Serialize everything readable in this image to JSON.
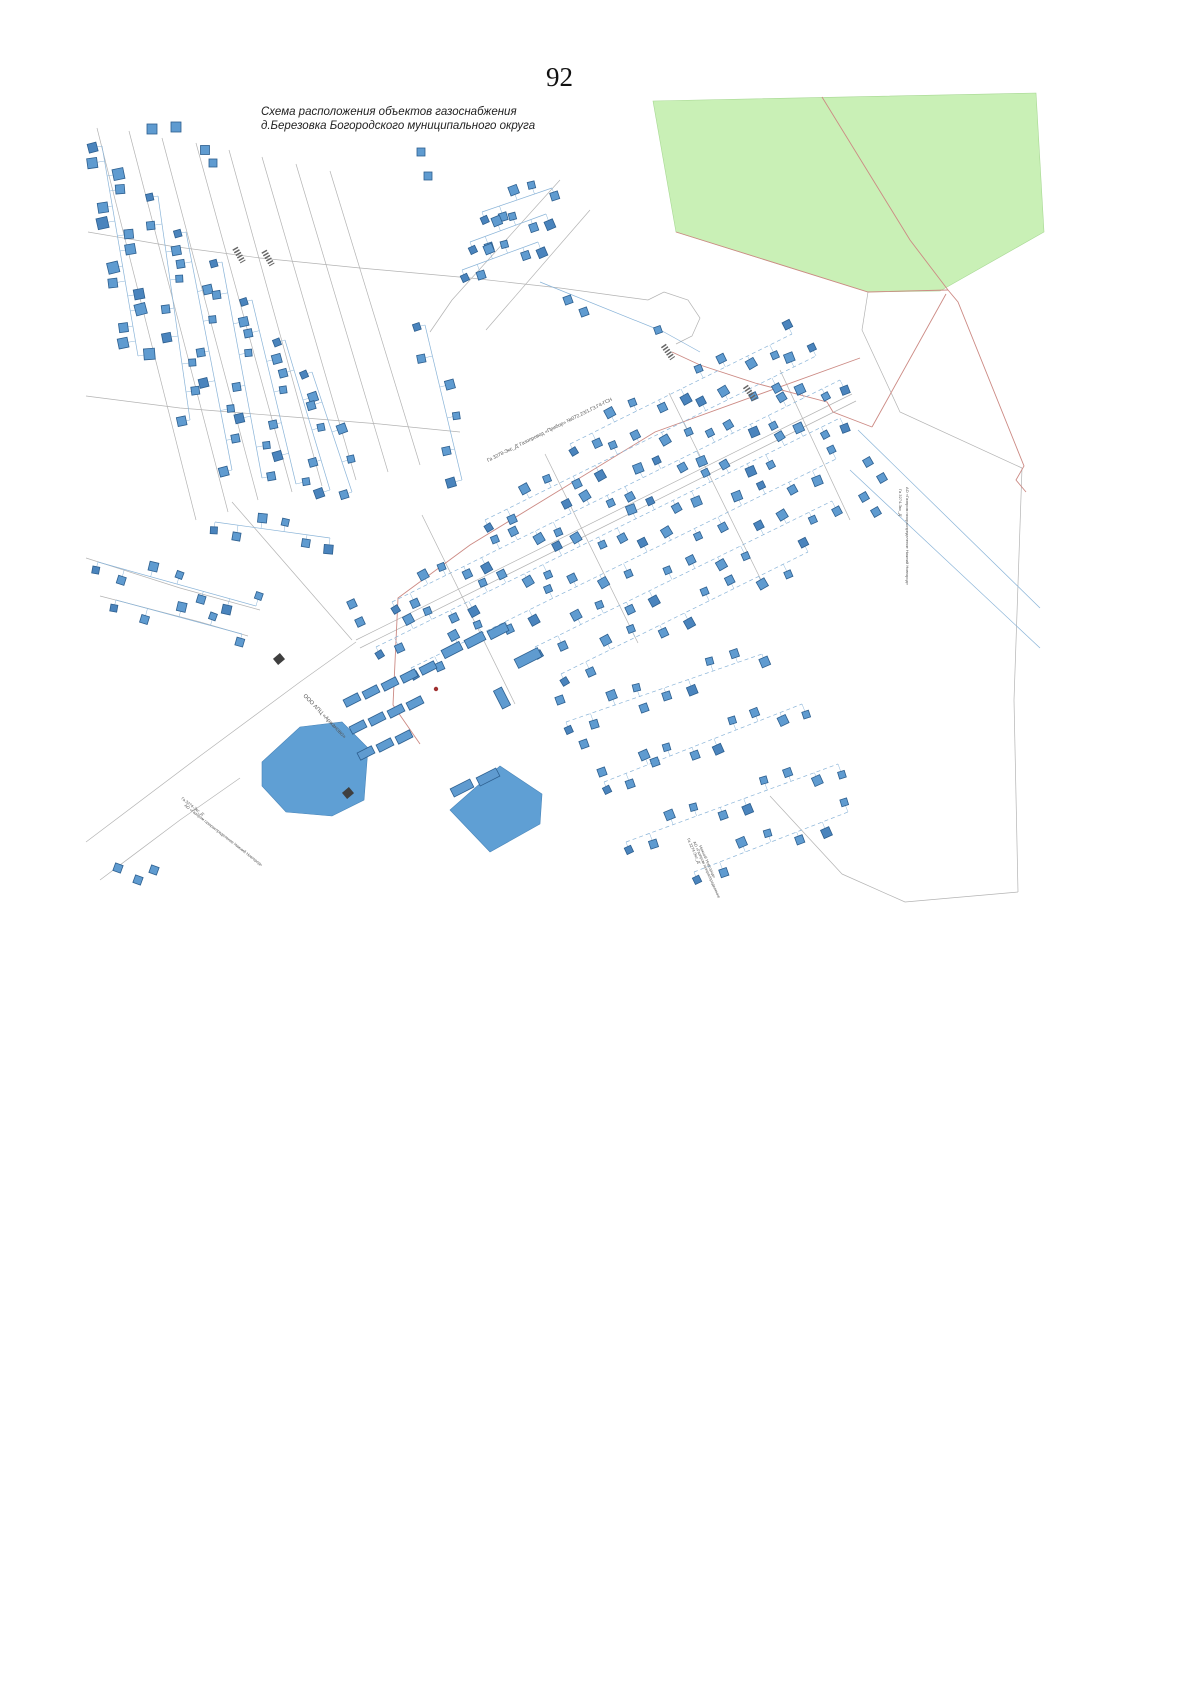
{
  "page": {
    "number": "92"
  },
  "title": {
    "line1": "Схема расположения объектов газоснабжения",
    "line2": "д.Березовка Богородского муниципального округа"
  },
  "colors": {
    "green": "#c9f0b6",
    "green_edge": "#a8d894",
    "pond": "#5f9fd4",
    "pond_edge": "#4a86ba",
    "road": "#b3b3b3",
    "boundary": "#cc8a84",
    "pipe": "#8ab4d8",
    "building": "#5f9bd0",
    "building_dark": "#4a84bd",
    "building_edge": "#2d5f8f",
    "label": "#555555",
    "marker_dark": "#3f3f3f",
    "red_dot": "#a03030"
  },
  "map": {
    "green_area": {
      "points": [
        [
          653,
          101
        ],
        [
          1036,
          93
        ],
        [
          1044,
          232
        ],
        [
          940,
          291
        ],
        [
          868,
          292
        ],
        [
          676,
          232
        ]
      ]
    },
    "ponds": [
      {
        "points": [
          [
            262,
            762
          ],
          [
            300,
            727
          ],
          [
            342,
            722
          ],
          [
            368,
            748
          ],
          [
            364,
            800
          ],
          [
            332,
            816
          ],
          [
            286,
            812
          ],
          [
            262,
            786
          ]
        ]
      },
      {
        "points": [
          [
            450,
            810
          ],
          [
            500,
            766
          ],
          [
            542,
            794
          ],
          [
            540,
            824
          ],
          [
            490,
            852
          ]
        ]
      }
    ],
    "roads": [
      [
        [
          88,
          232
        ],
        [
          170,
          246
        ],
        [
          260,
          258
        ],
        [
          360,
          268
        ],
        [
          470,
          278
        ],
        [
          560,
          288
        ],
        [
          618,
          296
        ],
        [
          648,
          300
        ],
        [
          664,
          292
        ],
        [
          688,
          300
        ],
        [
          700,
          318
        ],
        [
          692,
          336
        ],
        [
          676,
          344
        ]
      ],
      [
        [
          86,
          396
        ],
        [
          180,
          408
        ],
        [
          280,
          416
        ],
        [
          380,
          424
        ],
        [
          460,
          432
        ]
      ],
      [
        [
          97,
          128
        ],
        [
          196,
          520
        ]
      ],
      [
        [
          129,
          131
        ],
        [
          228,
          512
        ]
      ],
      [
        [
          162,
          138
        ],
        [
          258,
          500
        ]
      ],
      [
        [
          196,
          143
        ],
        [
          292,
          492
        ]
      ],
      [
        [
          229,
          150
        ],
        [
          322,
          486
        ]
      ],
      [
        [
          262,
          157
        ],
        [
          356,
          480
        ]
      ],
      [
        [
          296,
          164
        ],
        [
          388,
          472
        ]
      ],
      [
        [
          330,
          171
        ],
        [
          420,
          465
        ]
      ],
      [
        [
          452,
          300
        ],
        [
          560,
          180
        ]
      ],
      [
        [
          486,
          330
        ],
        [
          590,
          210
        ]
      ],
      [
        [
          430,
          332
        ],
        [
          452,
          300
        ]
      ],
      [
        [
          232,
          502
        ],
        [
          352,
          640
        ]
      ],
      [
        [
          356,
          640
        ],
        [
          852,
          394
        ]
      ],
      [
        [
          360,
          648
        ],
        [
          856,
          401
        ]
      ],
      [
        [
          422,
          515
        ],
        [
          515,
          704
        ]
      ],
      [
        [
          545,
          454
        ],
        [
          638,
          643
        ]
      ],
      [
        [
          669,
          393
        ],
        [
          762,
          582
        ]
      ],
      [
        [
          780,
          370
        ],
        [
          850,
          520
        ]
      ],
      [
        [
          86,
          842
        ],
        [
          200,
          756
        ],
        [
          300,
          682
        ],
        [
          356,
          642
        ]
      ],
      [
        [
          100,
          880
        ],
        [
          180,
          820
        ],
        [
          240,
          778
        ]
      ],
      [
        [
          86,
          558
        ],
        [
          180,
          588
        ],
        [
          260,
          610
        ]
      ],
      [
        [
          100,
          596
        ],
        [
          200,
          622
        ],
        [
          248,
          636
        ]
      ],
      [
        [
          868,
          292
        ],
        [
          862,
          330
        ],
        [
          900,
          412
        ],
        [
          1022,
          468
        ]
      ],
      [
        [
          1022,
          468
        ],
        [
          1014,
          700
        ],
        [
          1018,
          892
        ]
      ],
      [
        [
          1018,
          892
        ],
        [
          905,
          902
        ],
        [
          842,
          874
        ]
      ],
      [
        [
          770,
          796
        ],
        [
          842,
          874
        ]
      ]
    ],
    "red_lines": [
      [
        [
          822,
          97
        ],
        [
          910,
          240
        ],
        [
          948,
          290
        ],
        [
          958,
          302
        ],
        [
          1024,
          466
        ],
        [
          1016,
          480
        ],
        [
          1026,
          492
        ]
      ],
      [
        [
          676,
          232
        ],
        [
          868,
          292
        ],
        [
          948,
          290
        ]
      ],
      [
        [
          672,
          352
        ],
        [
          700,
          365
        ],
        [
          755,
          383
        ],
        [
          827,
          402
        ],
        [
          833,
          412
        ],
        [
          872,
          427
        ]
      ],
      [
        [
          872,
          427
        ],
        [
          946,
          294
        ]
      ],
      [
        [
          860,
          358
        ],
        [
          655,
          432
        ],
        [
          470,
          545
        ],
        [
          398,
          598
        ],
        [
          393,
          705
        ],
        [
          420,
          744
        ]
      ]
    ],
    "blue_lines": [
      [
        [
          540,
          282
        ],
        [
          664,
          332
        ]
      ],
      [
        [
          664,
          332
        ],
        [
          700,
          352
        ]
      ],
      [
        [
          858,
          430
        ],
        [
          1040,
          608
        ]
      ],
      [
        [
          850,
          470
        ],
        [
          1040,
          648
        ]
      ]
    ],
    "streets": [
      [
        102,
        146,
        138,
        356,
        15,
        10,
        "s"
      ],
      [
        158,
        196,
        190,
        420,
        9,
        8,
        "s"
      ],
      [
        186,
        232,
        232,
        470,
        9,
        8,
        "s"
      ],
      [
        222,
        262,
        262,
        478,
        8,
        8,
        "s"
      ],
      [
        252,
        300,
        296,
        484,
        7,
        8,
        "s"
      ],
      [
        285,
        340,
        330,
        490,
        6,
        8,
        "s"
      ],
      [
        312,
        372,
        352,
        492,
        5,
        8,
        "s"
      ],
      [
        482,
        212,
        552,
        188,
        5,
        8,
        "s"
      ],
      [
        470,
        242,
        546,
        214,
        6,
        8,
        "s"
      ],
      [
        462,
        270,
        538,
        242,
        6,
        8,
        "s"
      ],
      [
        425,
        325,
        462,
        480,
        6,
        8,
        "s"
      ],
      [
        392,
        602,
        840,
        380,
        26,
        8,
        "d"
      ],
      [
        485,
        520,
        816,
        356,
        16,
        8,
        "d"
      ],
      [
        570,
        444,
        792,
        334,
        11,
        8,
        "d"
      ],
      [
        376,
        647,
        840,
        418,
        26,
        8,
        "d"
      ],
      [
        411,
        668,
        836,
        459,
        19,
        8,
        "d"
      ],
      [
        535,
        647,
        832,
        501,
        14,
        8,
        "d"
      ],
      [
        561,
        674,
        808,
        552,
        11,
        8,
        "d"
      ],
      [
        566,
        722,
        762,
        654,
        9,
        8,
        "d"
      ],
      [
        604,
        782,
        802,
        704,
        10,
        8,
        "d"
      ],
      [
        626,
        842,
        838,
        764,
        10,
        8,
        "d"
      ],
      [
        694,
        872,
        848,
        812,
        7,
        8,
        "d"
      ],
      [
        98,
        562,
        256,
        606,
        7,
        8,
        "s"
      ],
      [
        116,
        600,
        242,
        634,
        5,
        8,
        "s"
      ],
      [
        215,
        522,
        330,
        538,
        6,
        8,
        "s"
      ]
    ],
    "singles": [
      [
        152,
        129,
        10,
        0
      ],
      [
        176,
        127,
        10,
        0
      ],
      [
        205,
        150,
        9,
        0
      ],
      [
        213,
        163,
        8,
        0
      ],
      [
        421,
        152,
        8,
        0
      ],
      [
        428,
        176,
        8,
        0
      ],
      [
        568,
        300,
        8,
        -20
      ],
      [
        584,
        312,
        8,
        -20
      ],
      [
        658,
        330,
        7,
        -20
      ],
      [
        868,
        462,
        8,
        -30
      ],
      [
        882,
        478,
        8,
        -30
      ],
      [
        864,
        497,
        8,
        -30
      ],
      [
        876,
        512,
        8,
        -30
      ],
      [
        352,
        604,
        8,
        -25
      ],
      [
        360,
        622,
        8,
        -25
      ],
      [
        560,
        700,
        8,
        -20
      ],
      [
        584,
        744,
        8,
        -20
      ],
      [
        602,
        772,
        8,
        -20
      ],
      [
        644,
        708,
        8,
        -20
      ],
      [
        655,
        762,
        8,
        -20
      ],
      [
        118,
        868,
        8,
        20
      ],
      [
        138,
        880,
        8,
        20
      ],
      [
        154,
        870,
        8,
        20
      ]
    ],
    "barns": [
      [
        352,
        700,
        16,
        8,
        -27
      ],
      [
        371,
        692,
        16,
        8,
        -27
      ],
      [
        390,
        684,
        16,
        8,
        -27
      ],
      [
        409,
        676,
        16,
        8,
        -27
      ],
      [
        428,
        668,
        16,
        8,
        -27
      ],
      [
        358,
        727,
        16,
        8,
        -27
      ],
      [
        377,
        719,
        16,
        8,
        -27
      ],
      [
        396,
        711,
        16,
        8,
        -27
      ],
      [
        415,
        703,
        16,
        8,
        -27
      ],
      [
        366,
        753,
        16,
        8,
        -27
      ],
      [
        385,
        745,
        16,
        8,
        -27
      ],
      [
        404,
        737,
        16,
        8,
        -27
      ],
      [
        452,
        650,
        20,
        9,
        -27
      ],
      [
        475,
        640,
        20,
        9,
        -27
      ],
      [
        498,
        631,
        20,
        9,
        -27
      ],
      [
        462,
        788,
        22,
        9,
        -27
      ],
      [
        488,
        777,
        22,
        9,
        -27
      ],
      [
        528,
        658,
        26,
        10,
        -27
      ],
      [
        502,
        698,
        20,
        9,
        63
      ]
    ],
    "dark_markers": [
      [
        279,
        659,
        -40
      ],
      [
        348,
        793,
        -40
      ]
    ],
    "hatch_markers": [
      [
        239,
        255,
        60
      ],
      [
        268,
        258,
        60
      ],
      [
        668,
        352,
        55
      ],
      [
        750,
        393,
        55
      ]
    ],
    "red_dot": {
      "x": 436,
      "y": 689
    },
    "labels": [
      {
        "text": "Га 3278-Экс_Д'  Газопровод «Прибор» №072.23/1.ГЗ.Г4-ГСН",
        "x": 488,
        "y": 462,
        "rot": -26.3,
        "size": 5
      },
      {
        "text": "ООО АПЦ «Аржаново»",
        "x": 303,
        "y": 696,
        "rot": 46,
        "size": 5.5
      },
      {
        "text": "Га 3274-Экс_Д'",
        "x": 181,
        "y": 799,
        "rot": 38,
        "size": 4
      },
      {
        "text": "АО «Газпром газораспределение Нижний Новгород»",
        "x": 184,
        "y": 806,
        "rot": 38,
        "size": 4
      },
      {
        "text": "Га 3274-Экс_Д'",
        "x": 687,
        "y": 839,
        "rot": 66,
        "size": 4
      },
      {
        "text": "АО «Газпром газораспределение",
        "x": 693,
        "y": 842,
        "rot": 66,
        "size": 4
      },
      {
        "text": "Нижний Новгород»",
        "x": 699,
        "y": 846,
        "rot": 66,
        "size": 4
      },
      {
        "text": "Га 3274-Экс_Д'",
        "x": 899,
        "y": 489,
        "rot": 90,
        "size": 4
      },
      {
        "text": "АО «Газпром газораспределение Нижний Новгород»",
        "x": 906,
        "y": 487,
        "rot": 90,
        "size": 4
      }
    ]
  }
}
